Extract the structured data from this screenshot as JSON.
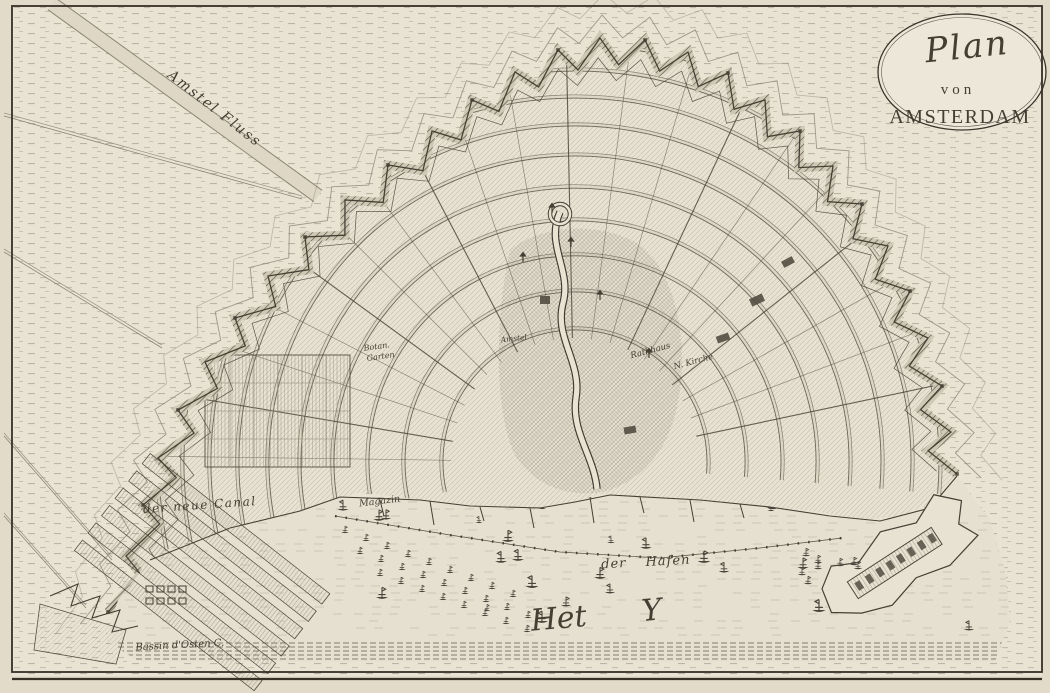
{
  "map": {
    "cartouche": {
      "line1": "Plan",
      "line2": "von",
      "line3": "AMSTERDAM"
    },
    "labels": {
      "amstel_river": "Amstel Fluss",
      "new_canal": "der neue Canal",
      "magazine": "Magazin",
      "town_hall": "Rathhaus",
      "new_church": "N. Kirche",
      "botanical_garden_1": "Botan.",
      "botanical_garden_2": "Garten",
      "inner_amstel": "Amstel",
      "harbor": "der Hafen",
      "ij_bay": "Het Y",
      "east_basin": "Bassin d'Osten C."
    },
    "colors": {
      "paper": "#e9e3d4",
      "paper_margin": "#e2dbca",
      "city": "#e8e2d3",
      "water": "#e6e0d1",
      "ink": "#453f34",
      "ink_light": "#8d8574",
      "hatch": "#a89f8d",
      "cartouche_fill": "#ece7d9"
    }
  }
}
